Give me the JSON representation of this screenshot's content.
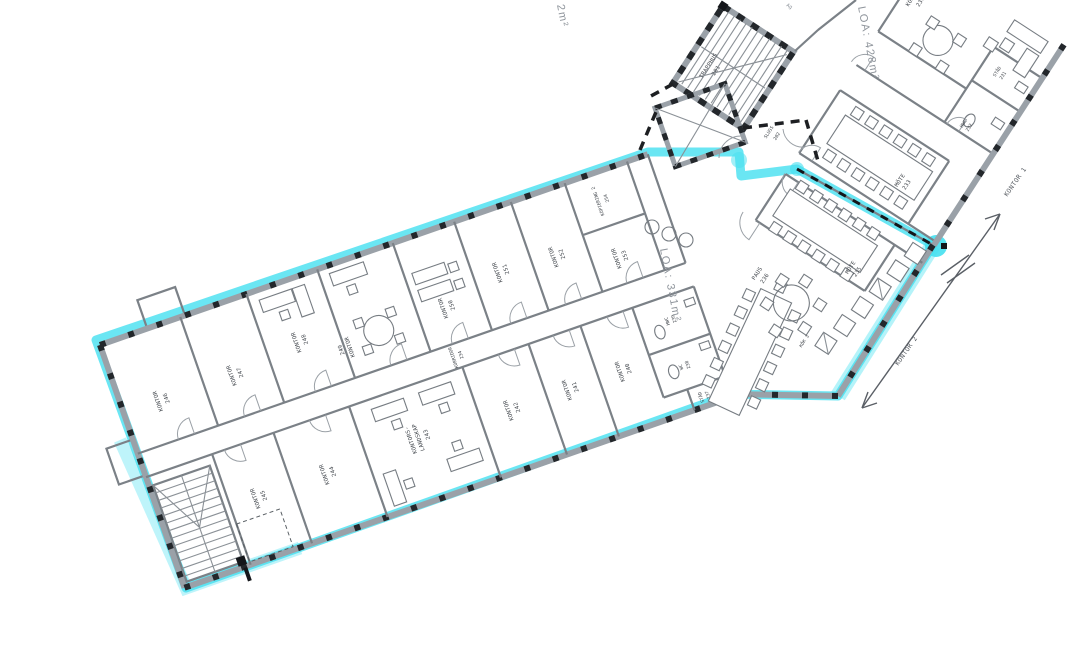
{
  "plan": {
    "colors": {
      "highlight": "#45E0F0",
      "wall": "#9aa1a8",
      "wall_dark": "#23272b",
      "text": "#41464c"
    },
    "areas": {
      "loa_left_partial": "2m²",
      "loa_331": "LOA: 331m²",
      "loa_428": "LOA: 428m²"
    },
    "sections": {
      "kontor1": "KONTOR 1",
      "kontor2": "KONTOR 2"
    },
    "fragments": {
      "top": "Ag"
    },
    "rooms": {
      "r201": {
        "name": "TRAPPHUS",
        "num": "201"
      },
      "r202": {
        "name": "SLUSS",
        "num": "202"
      },
      "r230": {
        "name": "KONTOR",
        "num": "230"
      },
      "r231": {
        "name": "STÄD",
        "num": "231"
      },
      "r232": {
        "name": "HWC",
        "num": "232"
      },
      "r233": {
        "name": "MÖTE",
        "num": "233"
      },
      "r234": {
        "name": "KORRIDOR",
        "num": "234"
      },
      "r235": {
        "name": "MÖTE",
        "num": "235"
      },
      "r236": {
        "name": "PAUS",
        "num": "236"
      },
      "r237": {
        "name": "STÄD",
        "num": "237"
      },
      "r238": {
        "name": "WC",
        "num": "238"
      },
      "r239": {
        "name": "HWC",
        "num": "239"
      },
      "r240": {
        "name": "KONTOR",
        "num": "240"
      },
      "r241": {
        "name": "KONTOR",
        "num": "241"
      },
      "r242": {
        "name": "KONTOR",
        "num": "242"
      },
      "r243": {
        "name1": "KONTORS-",
        "name2": "LANDSKAP",
        "num": "243"
      },
      "r244": {
        "name": "KONTOR",
        "num": "244"
      },
      "r245": {
        "name": "KONTOR",
        "num": "245"
      },
      "r246": {
        "name": "KONTOR",
        "num": "246"
      },
      "r247": {
        "name": "KONTOR",
        "num": "247"
      },
      "r248": {
        "name": "KONTOR",
        "num": "248"
      },
      "r249": {
        "name": "KONTOR",
        "num": "249"
      },
      "r250": {
        "name": "KONTOR",
        "num": "250"
      },
      "r251": {
        "name": "KONTOR",
        "num": "251"
      },
      "r252": {
        "name": "KONTOR",
        "num": "252"
      },
      "r253": {
        "name": "KONTOR",
        "num": "253"
      },
      "r254": {
        "name": "KOPIERING 2",
        "num": "254"
      },
      "kok": {
        "label": "KÖK 3"
      }
    }
  }
}
